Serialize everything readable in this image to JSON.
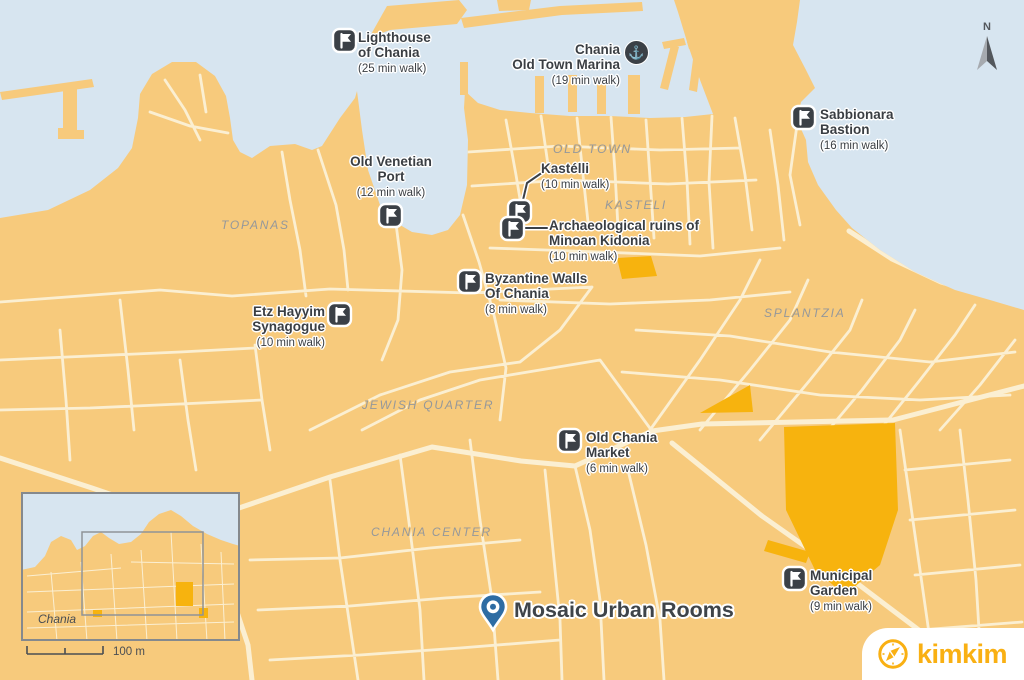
{
  "brand": {
    "logo_text": "kimkim"
  },
  "compass": {
    "label": "N"
  },
  "inset": {
    "place_label": "Chania",
    "scale_label": "100 m"
  },
  "destination": {
    "name": "Mosaic Urban Rooms"
  },
  "regions": [
    {
      "text": "OLD TOWN"
    },
    {
      "text": "KASTELI"
    },
    {
      "text": "TOPANAS"
    },
    {
      "text": "SPLANTZIA"
    },
    {
      "text": "JEWISH QUARTER"
    },
    {
      "text": "CHANIA CENTER"
    }
  ],
  "pois": [
    {
      "line1": "Lighthouse",
      "line2": "of Chania",
      "walk": "(25 min walk)",
      "icon": "flag-icon"
    },
    {
      "line1": "Chania",
      "line2": "Old Town Marina",
      "walk": "(19 min walk)",
      "icon": "anchor-icon"
    },
    {
      "line1": "Sabbionara",
      "line2": "Bastion",
      "walk": "(16 min walk)",
      "icon": "flag-icon"
    },
    {
      "line1": "Old Venetian",
      "line2": "Port",
      "walk": "(12 min walk)",
      "icon": "flag-icon"
    },
    {
      "line1": "Kastélli",
      "line2": "",
      "walk": "(10 min walk)",
      "icon": "flag-icon"
    },
    {
      "line1": "Archaeological ruins of",
      "line2": "Minoan Kidonia",
      "walk": "(10 min walk)",
      "icon": "flag-icon"
    },
    {
      "line1": "Byzantine Walls",
      "line2": "Of Chania",
      "walk": "(8 min walk)",
      "icon": "flag-icon"
    },
    {
      "line1": "Etz Hayyim",
      "line2": "Synagogue",
      "walk": "(10 min walk)",
      "icon": "flag-icon"
    },
    {
      "line1": "Old Chania",
      "line2": "Market",
      "walk": "(6 min walk)",
      "icon": "flag-icon"
    },
    {
      "line1": "Municipal",
      "line2": "Garden",
      "walk": "(9 min walk)",
      "icon": "flag-icon"
    }
  ],
  "colors": {
    "water": "#D7E5F0",
    "land": "#F7CA7C",
    "street": "#FBEFD2",
    "park": "#F7B30E",
    "marker_dark": "#3B4046",
    "pin_blue": "#2E6CA3",
    "brand_yellow": "#F9B013",
    "label_dark": "#3A3E43",
    "region_gray": "#95989B"
  }
}
